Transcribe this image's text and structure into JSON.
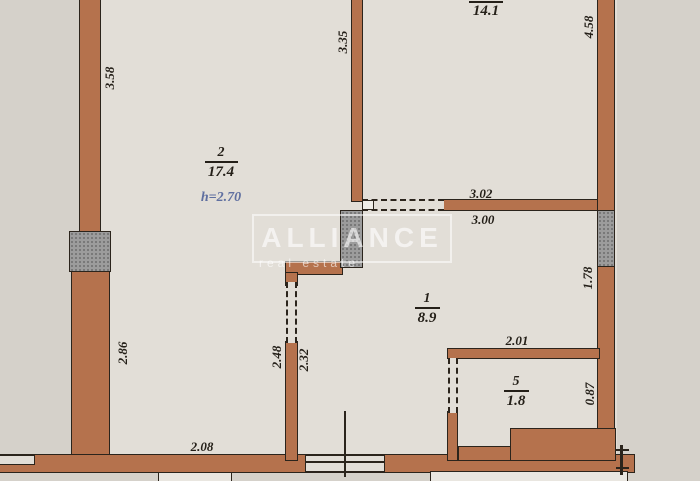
{
  "watermark": {
    "title": "ALLIANCE",
    "subtitle": "real estate"
  },
  "rooms": [
    {
      "id": "room-2",
      "number": "2",
      "area": "17.4",
      "note": "h=2.70"
    },
    {
      "id": "room-top",
      "number": "",
      "area": "14.1",
      "note": ""
    },
    {
      "id": "room-1",
      "number": "1",
      "area": "8.9",
      "note": ""
    },
    {
      "id": "room-5",
      "number": "5",
      "area": "1.8",
      "note": ""
    }
  ],
  "dimensions": [
    {
      "value": "3.58"
    },
    {
      "value": "2.86"
    },
    {
      "value": "3.35"
    },
    {
      "value": "4.58"
    },
    {
      "value": "3.02"
    },
    {
      "value": "3.00"
    },
    {
      "value": "1.78"
    },
    {
      "value": "2.01"
    },
    {
      "value": "0.87"
    },
    {
      "value": "2.48"
    },
    {
      "value": "2.32"
    },
    {
      "value": "2.08"
    }
  ],
  "colors": {
    "wall": "#b5724d",
    "outline": "#2b241c",
    "pillar": "#9c9c9c",
    "pillar_dot": "#767676",
    "paper": "#d5d1ca",
    "room": "#e2ded7",
    "ink": "#241f18",
    "note_blue": "#5f6fa0",
    "watermark": "#ffffff"
  }
}
